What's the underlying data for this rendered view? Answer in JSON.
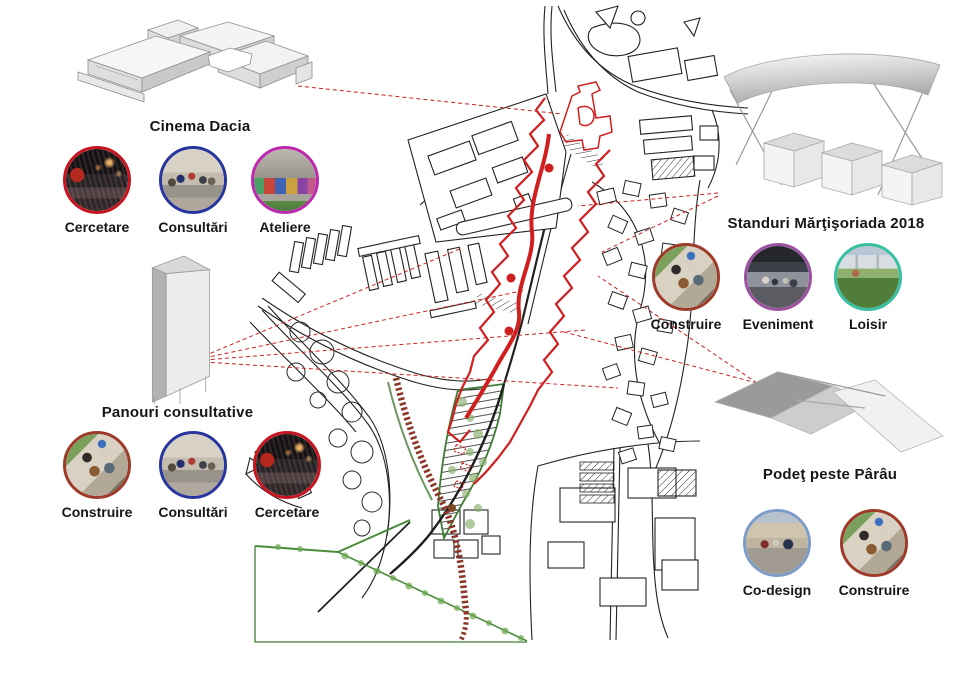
{
  "callouts": [
    {
      "id": "cinema-dacia",
      "title": "Cinema Dacia",
      "model_icon": "cinema-building-axonometric",
      "activities": [
        {
          "label": "Cercetare",
          "ring": "#c81420",
          "photo": "cinema-audience"
        },
        {
          "label": "Consultări",
          "ring": "#28359e",
          "photo": "group-consultation"
        },
        {
          "label": "Ateliere",
          "ring": "#bc28ae",
          "photo": "graffiti-workshop"
        }
      ]
    },
    {
      "id": "panouri-consultative",
      "title": "Panouri consultative",
      "model_icon": "consultation-panel-prism",
      "activities": [
        {
          "label": "Construire",
          "ring": "#9e3a28",
          "photo": "wood-construction"
        },
        {
          "label": "Consultări",
          "ring": "#28359e",
          "photo": "group-consultation"
        },
        {
          "label": "Cercetare",
          "ring": "#c81420",
          "photo": "cinema-audience"
        }
      ]
    },
    {
      "id": "standuri-martisoriada",
      "title": "Standuri Mărţişoriada 2018",
      "model_icon": "market-stands-canopy",
      "activities": [
        {
          "label": "Construire",
          "ring": "#9e3a28",
          "photo": "wood-construction"
        },
        {
          "label": "Eveniment",
          "ring": "#9b50a0",
          "photo": "market-event"
        },
        {
          "label": "Loisir",
          "ring": "#38bfa0",
          "photo": "park-leisure"
        }
      ]
    },
    {
      "id": "podet-peste-parau",
      "title": "Podeţ peste Pârâu",
      "model_icon": "footbridge-axonometric",
      "activities": [
        {
          "label": "Co-design",
          "ring": "#7e9cc8",
          "photo": "street-codesign"
        },
        {
          "label": "Construire",
          "ring": "#9e3a28",
          "photo": "wood-construction"
        }
      ]
    }
  ],
  "colors": {
    "leader_red": "#cc2222",
    "corridor_red": "#d01f1f",
    "map_green": "#3f7d36",
    "ladder_brown": "#8a3526",
    "map_ink": "#222222"
  }
}
